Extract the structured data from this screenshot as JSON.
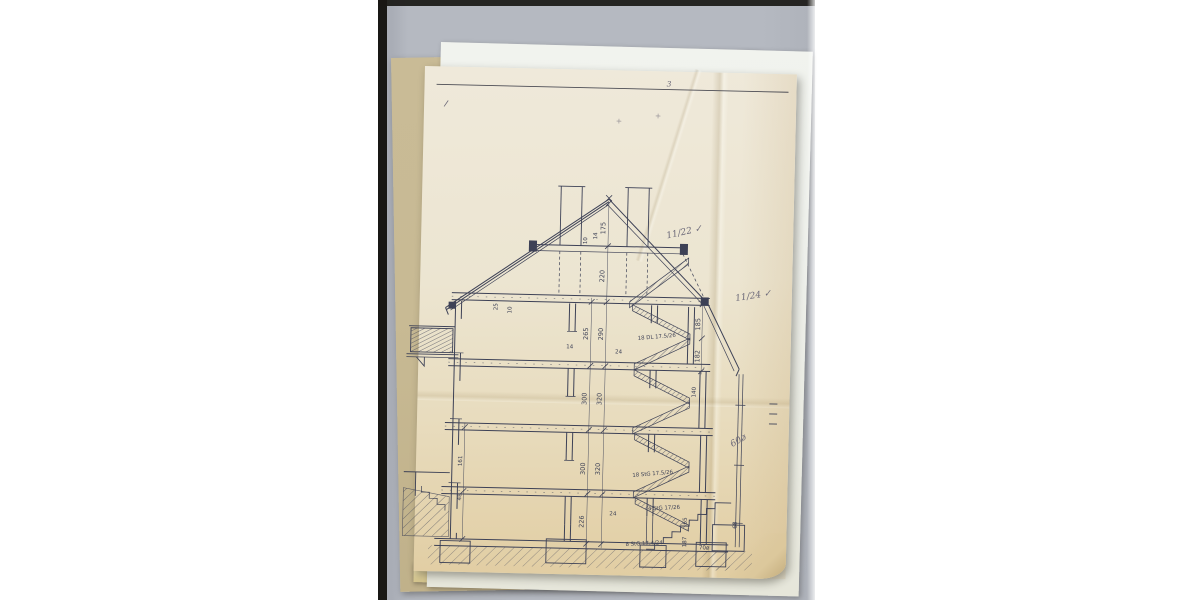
{
  "colors": {
    "page_background": "#ffffff",
    "scanner_background": "#b5b9c1",
    "scan_edge": "#191815",
    "sheet_tan": "#c8ba94",
    "sheet_white": "#eef0eb",
    "sheet_cream_top": "#efe9da",
    "sheet_cream_bottom": "#e1cda2",
    "ink": "#3d4156",
    "pencil": "#6b6878",
    "border_line": "#4c4c54"
  },
  "sheet": {
    "corner_pencil_mark": "3",
    "pencil_notes": {
      "note_roof_upper": "11/22 ✓",
      "note_roof_lower": "11/24 ✓",
      "note_ground": "60ø"
    },
    "plus_marks": {
      "a": "+",
      "b": "+"
    }
  },
  "section_drawing": {
    "dim_center_floor": [
      "175",
      "220",
      "290",
      "320",
      "320"
    ],
    "dim_center_clear": [
      "265",
      "300",
      "300",
      "226"
    ],
    "dim_ridge": [
      "14",
      "10"
    ],
    "dim_eave": [
      "25",
      "10"
    ],
    "dim_right": [
      "185",
      "182",
      "140"
    ],
    "dim_right_lower": [
      "65",
      "187",
      "68",
      "70ø"
    ],
    "dim_left_wall": [
      "161",
      "48"
    ],
    "dim_small": [
      "14",
      "24",
      "24"
    ],
    "stair_labels": [
      "18 DL 17.5/26",
      "18 StG 17.5/26",
      "4 StG 17/26",
      "8 StG 17.4/24"
    ]
  }
}
